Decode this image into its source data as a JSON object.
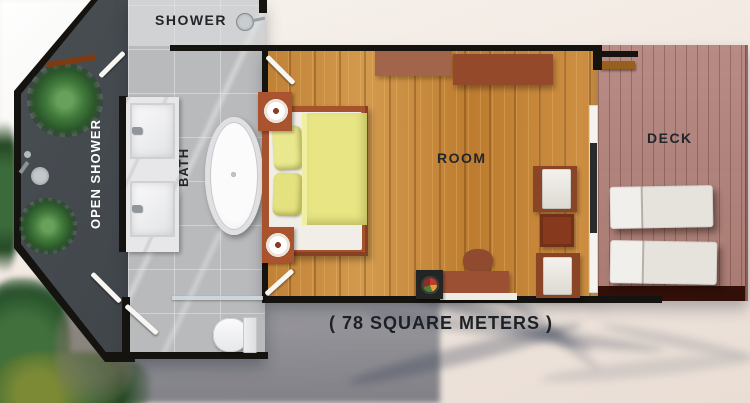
{
  "plan": {
    "labels": {
      "shower": "SHOWER",
      "open_shower": "OPEN SHOWER",
      "bath": "BATH",
      "room": "ROOM",
      "deck": "DECK"
    },
    "area_caption": "( 78 SQUARE METERS )",
    "fixtures": [
      "shower-head",
      "outdoor-shower-head",
      "wooden-bench",
      "palm-plant",
      "palm-plant",
      "double-vanity-sink",
      "double-vanity-sink",
      "freestanding-bathtub",
      "toilet",
      "glass-partition",
      "double-bed",
      "yellow-pillows",
      "yellow-duvet",
      "bedside-table",
      "bedside-table",
      "wall-console",
      "wall-console",
      "armchair",
      "armchair",
      "side-table",
      "desk",
      "desk-chair",
      "decor-tray",
      "sliding-glass-door",
      "sun-lounger",
      "sun-lounger",
      "deck-beam"
    ]
  },
  "colors": {
    "wall": "#15130f",
    "open_shower_floor": "#41464b",
    "bath_tile": "#b9babc",
    "shower_tile": "#cdcecf",
    "marble_counter": "#e7e7e9",
    "wood_floor": "#c98e43",
    "bed_frame": "#a6522c",
    "linen": "#e7e584",
    "mattress": "#f0eee7",
    "deck_wood": "#b2827a",
    "deck_edge": "#330f09",
    "lounger": "#efece8",
    "chair_wood": "#8a4527",
    "table_wood": "#87391e",
    "sand": "#f2eae2",
    "foam": "#fdfdfc",
    "shadow_blue": "#46536a",
    "foliage": "#2f5a33",
    "label_dark": "#22262a",
    "label_light": "#ffffff"
  }
}
